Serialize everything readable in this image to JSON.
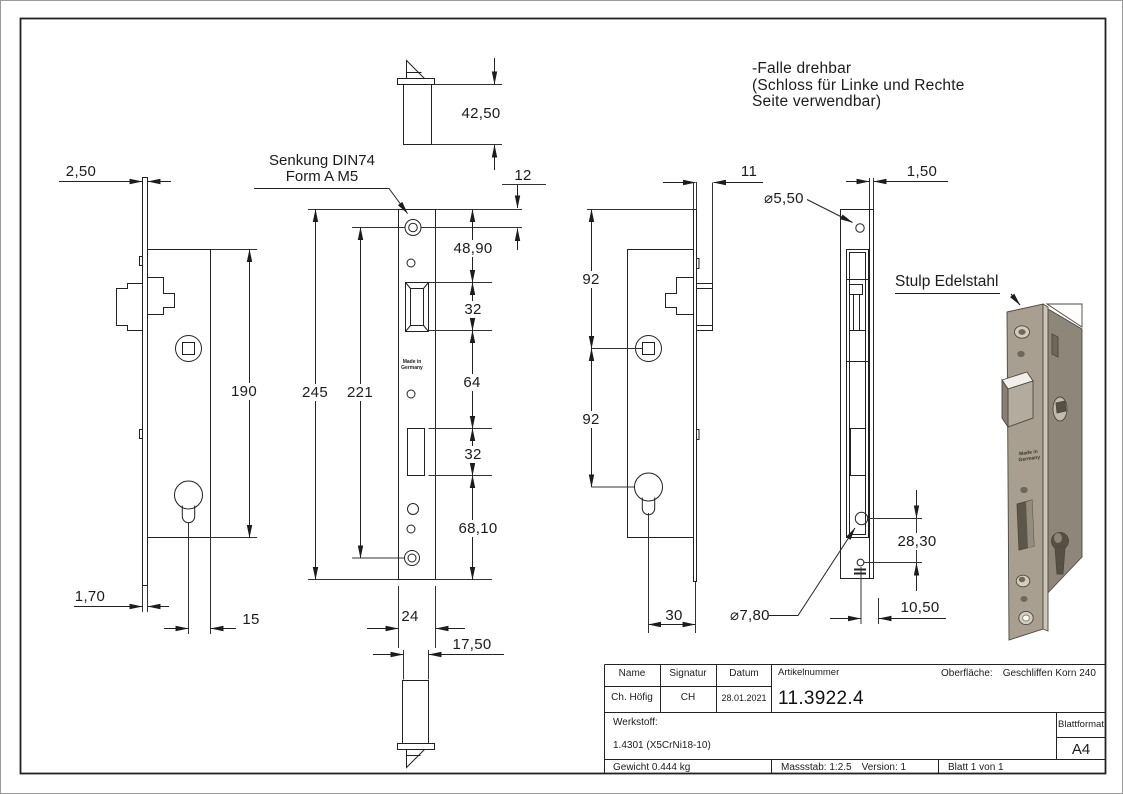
{
  "note": {
    "lines": [
      "-Falle drehbar",
      "(Schloss für Linke und Rechte",
      "Seite verwendbar)"
    ]
  },
  "callouts": {
    "senkung": [
      "Senkung DIN74",
      "Form A M5"
    ],
    "stulp": "Stulp Edelstahl",
    "made_in": [
      "Made in",
      "Germany"
    ]
  },
  "dims": {
    "plate_offset": "2,50",
    "lock_depth": "42,50",
    "top_offset": "12",
    "latch_top": "48,90",
    "latch_height": "32",
    "mid_spacing": "64",
    "bolt_height": "32",
    "bottom_section": "68,10",
    "total_height": "245",
    "hole_spacing": "221",
    "body_height": "190",
    "plate_thickness": "1,70",
    "backset": "15",
    "faceplate_width": "24",
    "body_width": "17,50",
    "latch_projection": "11",
    "spindle_distance": "92",
    "cylinder_distance": "92",
    "cylinder_backset": "30",
    "hole_dia_small": "⌀5,50",
    "hole_dia_large": "⌀7,80",
    "stulp_thickness": "1,50",
    "hole_offset": "28,30",
    "edge_offset": "10,50"
  },
  "title_block": {
    "name_label": "Name",
    "signatur_label": "Signatur",
    "datum_label": "Datum",
    "artikelnummer_label": "Artikelnummer",
    "oberflaeche_label": "Oberfläche:",
    "oberflaeche_value": "Geschliffen Korn 240",
    "name_value": "Ch. Höfig",
    "signatur_value": "CH",
    "datum_value": "28.01.2021",
    "artikelnummer_value": "11.3922.4",
    "werkstoff_label": "Werkstoff:",
    "werkstoff_value": "1.4301 (X5CrNi18-10)",
    "blattformat_label": "Blattformat",
    "blattformat_value": "A4",
    "gewicht": "Gewicht 0.444 kg",
    "massstab": "Massstab: 1:2.5",
    "version": "Version: 1",
    "blatt": "Blatt 1 von 1"
  }
}
